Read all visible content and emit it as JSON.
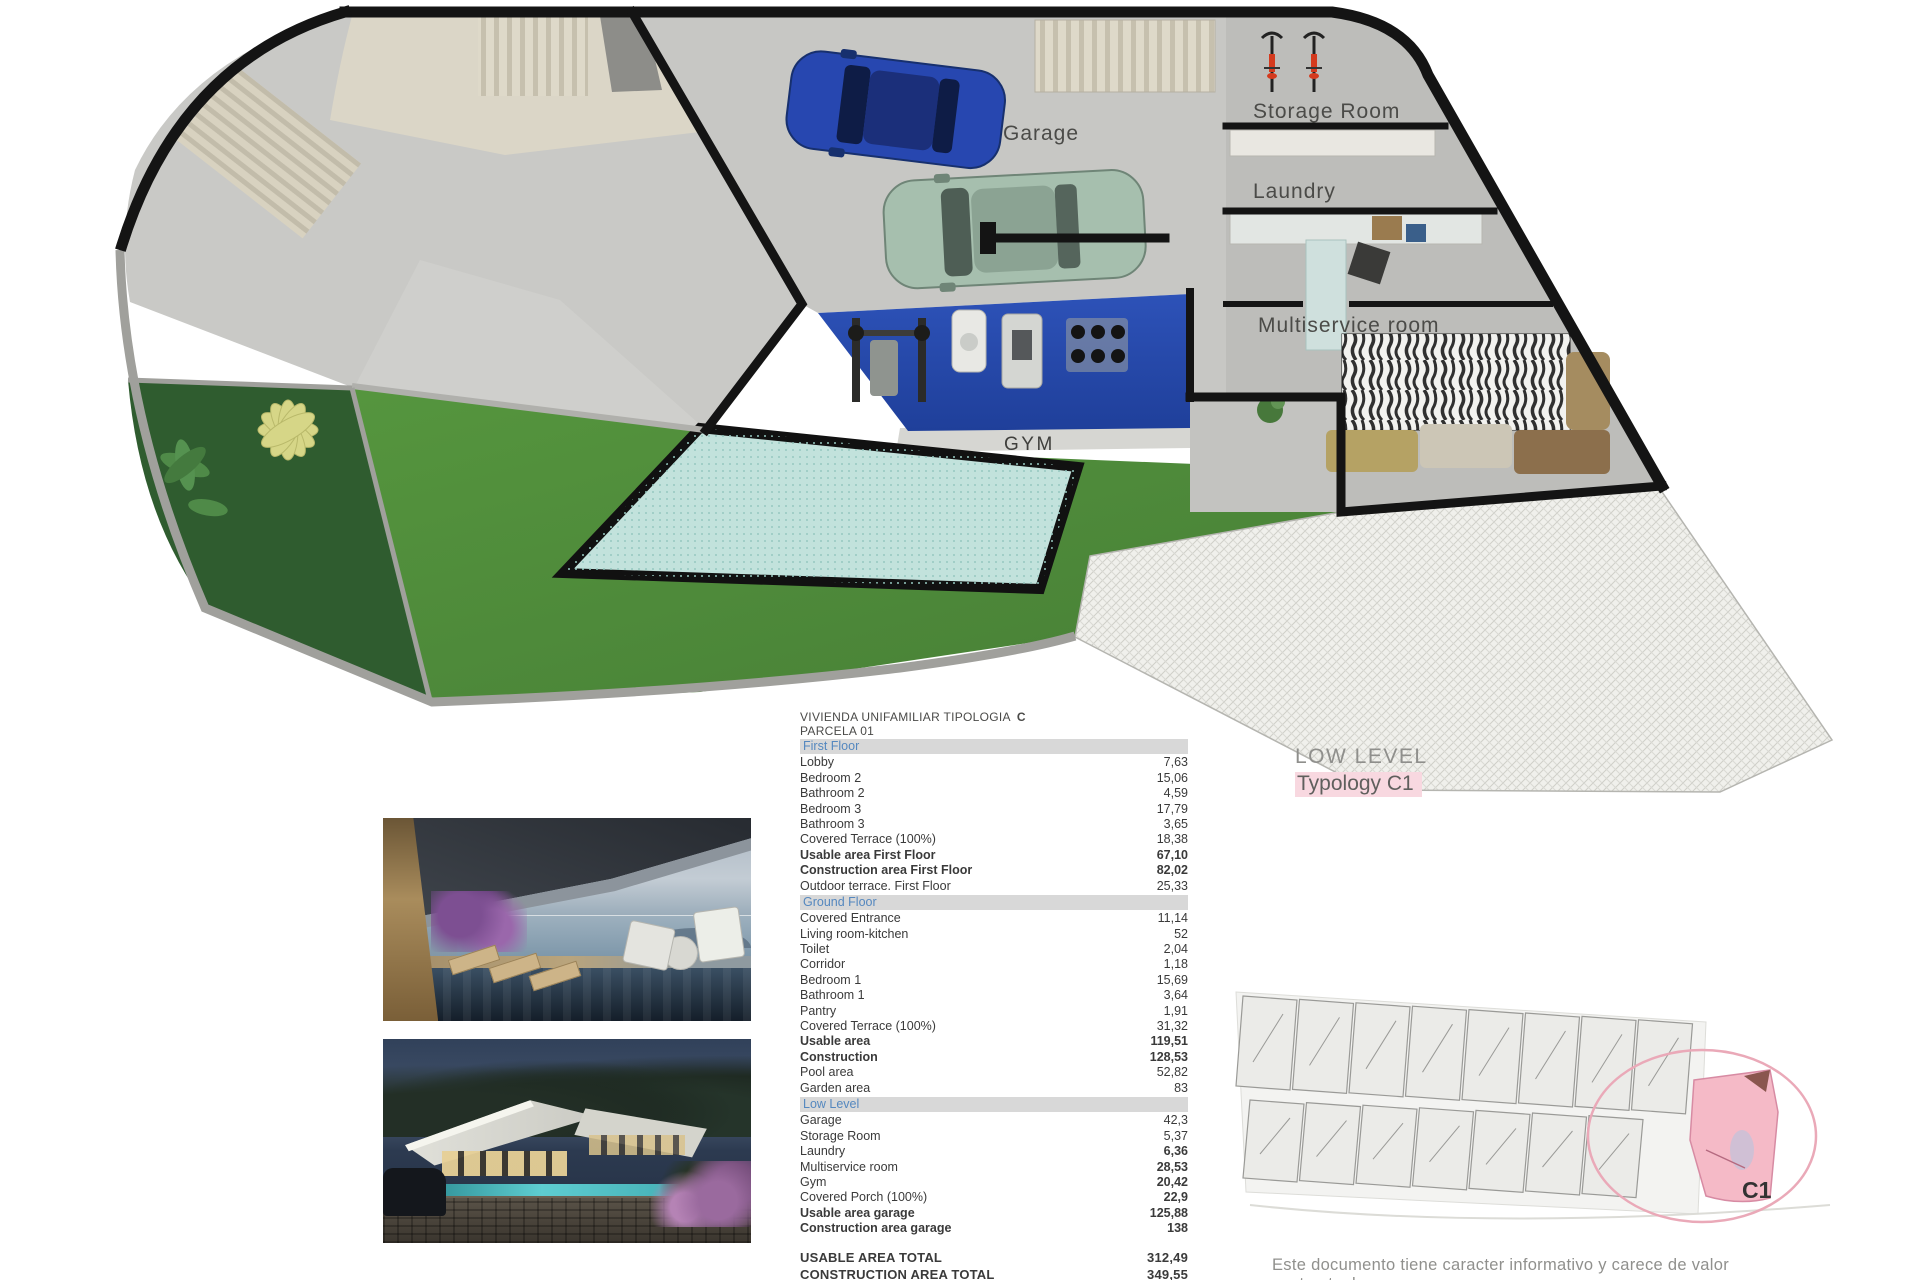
{
  "plan": {
    "labels": {
      "garage": "Garage",
      "storage_room": "Storage Room",
      "laundry": "Laundry",
      "multiservice_room": "Multiservice room",
      "gym": "GYM"
    }
  },
  "header": {
    "title": "VIVIENDA UNIFAMILIAR TIPOLOGIA",
    "title_code": "C",
    "subtitle": "PARCELA 01"
  },
  "level_caption": {
    "line1": "LOW LEVEL",
    "line2": "Typology C1"
  },
  "table": {
    "sections": [
      {
        "header": "First Floor",
        "rows": [
          {
            "label": "Lobby",
            "value": "7,63",
            "bold": "none"
          },
          {
            "label": "Bedroom 2",
            "value": "15,06",
            "bold": "none"
          },
          {
            "label": "Bathroom 2",
            "value": "4,59",
            "bold": "none"
          },
          {
            "label": "Bedroom 3",
            "value": "17,79",
            "bold": "none"
          },
          {
            "label": "Bathroom 3",
            "value": "3,65",
            "bold": "none"
          },
          {
            "label": "Covered Terrace (100%)",
            "value": "18,38",
            "bold": "none"
          },
          {
            "label": "Usable area First Floor",
            "value": "67,10",
            "bold": "both"
          },
          {
            "label": "Construction area First Floor",
            "value": "82,02",
            "bold": "both"
          },
          {
            "label": "Outdoor terrace.  First Floor",
            "value": "25,33",
            "bold": "none"
          }
        ]
      },
      {
        "header": "Ground Floor",
        "rows": [
          {
            "label": "Covered Entrance",
            "value": "11,14",
            "bold": "none"
          },
          {
            "label": "Living room-kitchen",
            "value": "52",
            "bold": "none"
          },
          {
            "label": "Toilet",
            "value": "2,04",
            "bold": "none"
          },
          {
            "label": "Corridor",
            "value": "1,18",
            "bold": "none"
          },
          {
            "label": "Bedroom 1",
            "value": "15,69",
            "bold": "none"
          },
          {
            "label": "Bathroom 1",
            "value": "3,64",
            "bold": "none"
          },
          {
            "label": "Pantry",
            "value": "1,91",
            "bold": "none"
          },
          {
            "label": "Covered Terrace (100%)",
            "value": "31,32",
            "bold": "none"
          },
          {
            "label": "Usable area",
            "value": "119,51",
            "bold": "both"
          },
          {
            "label": "Construction",
            "value": "128,53",
            "bold": "both"
          },
          {
            "label": "Pool area",
            "value": "52,82",
            "bold": "none"
          },
          {
            "label": "Garden area",
            "value": "83",
            "bold": "none"
          }
        ]
      },
      {
        "header": "Low Level",
        "rows": [
          {
            "label": "Garage",
            "value": "42,3",
            "bold": "none"
          },
          {
            "label": "Storage Room",
            "value": "5,37",
            "bold": "none"
          },
          {
            "label": "Laundry",
            "value": "6,36",
            "bold": "value"
          },
          {
            "label": "Multiservice room",
            "value": "28,53",
            "bold": "value"
          },
          {
            "label": "Gym",
            "value": "20,42",
            "bold": "value"
          },
          {
            "label": "Covered Porch (100%)",
            "value": "22,9",
            "bold": "value"
          },
          {
            "label": "Usable area garage",
            "value": "125,88",
            "bold": "both"
          },
          {
            "label": "Construction area garage",
            "value": "138",
            "bold": "both"
          }
        ]
      }
    ],
    "totals": [
      {
        "label": "USABLE AREA TOTAL",
        "value": "312,49"
      },
      {
        "label": "CONSTRUCTION AREA TOTAL",
        "value": "349,55"
      }
    ]
  },
  "site_plan": {
    "unit_label": "C1",
    "top_row_units": 8,
    "bottom_row_units": 7
  },
  "disclaimer": "Este documento tiene caracter informativo y carece de valor contractual",
  "colors": {
    "section_header_text": "#5588bf",
    "section_header_bg": "#d8d8d8",
    "typology_highlight": "#f8d8e0",
    "site_highlight": "#f5bac7",
    "gym_mat": "#2d52b8",
    "pool": "#c2e2dc",
    "lawn": "#549441",
    "plant_bed": "#2f5c2f"
  }
}
